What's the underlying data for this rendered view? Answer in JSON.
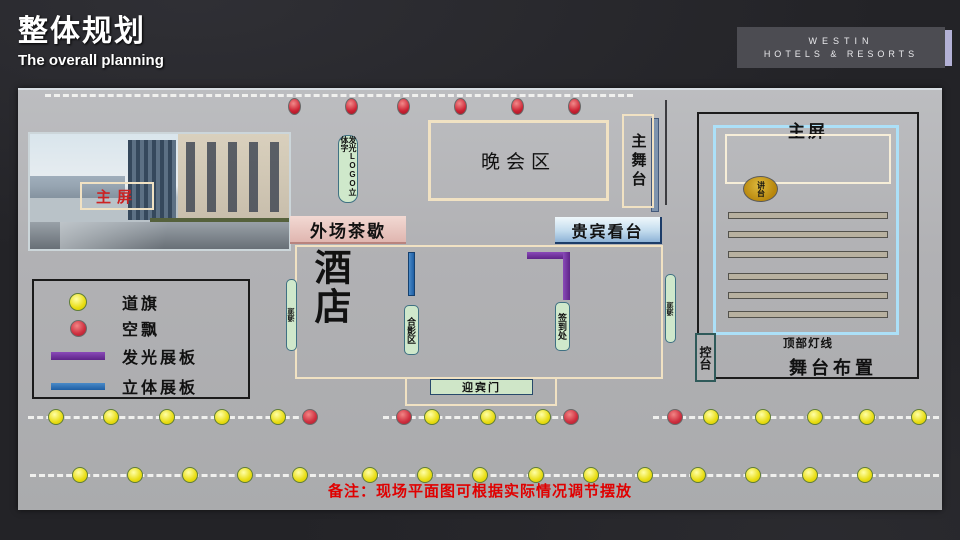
{
  "slide": {
    "title": "整体规划",
    "subtitle": "The overall planning",
    "brand_line1": "WESTIN",
    "brand_line2": "HOTELS & RESORTS"
  },
  "plan": {
    "photo_screen_label": "主屏",
    "logo_pillar_label": "发光LOGO立体字",
    "party_area_label": "晚会区",
    "main_stage_label": "主舞台",
    "tea_break_label": "外场茶歇",
    "vip_stand_label": "贵宾看台",
    "hotel_label": "酒店",
    "left_passage_label": "通道",
    "right_passage_label": "通道",
    "photo_area_label": "合影区",
    "signin_label": "签到处",
    "welcome_gate_label": "迎宾门",
    "note": "备注：现场平面图可根据实际情况调节摆放",
    "top_balloons": {
      "y": 8,
      "xs": [
        270,
        327,
        379,
        436,
        493,
        550
      ]
    },
    "dot_rows": [
      {
        "y": 319,
        "dots": [
          {
            "x": 30,
            "c": "yellow"
          },
          {
            "x": 85,
            "c": "yellow"
          },
          {
            "x": 141,
            "c": "yellow"
          },
          {
            "x": 196,
            "c": "yellow"
          },
          {
            "x": 252,
            "c": "yellow"
          },
          {
            "x": 284,
            "c": "red"
          },
          {
            "x": 378,
            "c": "red"
          },
          {
            "x": 406,
            "c": "yellow"
          },
          {
            "x": 462,
            "c": "yellow"
          },
          {
            "x": 517,
            "c": "yellow"
          },
          {
            "x": 545,
            "c": "red"
          },
          {
            "x": 649,
            "c": "red"
          },
          {
            "x": 685,
            "c": "yellow"
          },
          {
            "x": 737,
            "c": "yellow"
          },
          {
            "x": 789,
            "c": "yellow"
          },
          {
            "x": 841,
            "c": "yellow"
          },
          {
            "x": 893,
            "c": "yellow"
          }
        ]
      },
      {
        "y": 377,
        "dots": [
          {
            "x": 54,
            "c": "yellow"
          },
          {
            "x": 109,
            "c": "yellow"
          },
          {
            "x": 164,
            "c": "yellow"
          },
          {
            "x": 219,
            "c": "yellow"
          },
          {
            "x": 274,
            "c": "yellow"
          },
          {
            "x": 344,
            "c": "yellow"
          },
          {
            "x": 399,
            "c": "yellow"
          },
          {
            "x": 454,
            "c": "yellow"
          },
          {
            "x": 510,
            "c": "yellow"
          },
          {
            "x": 565,
            "c": "yellow"
          },
          {
            "x": 619,
            "c": "yellow"
          },
          {
            "x": 672,
            "c": "yellow"
          },
          {
            "x": 727,
            "c": "yellow"
          },
          {
            "x": 784,
            "c": "yellow"
          },
          {
            "x": 839,
            "c": "yellow"
          }
        ]
      }
    ]
  },
  "legend": {
    "items": [
      {
        "type": "yellow-dot",
        "label": "道旗"
      },
      {
        "type": "red-dot",
        "label": "空飘"
      },
      {
        "type": "purple-bar",
        "label": "发光展板"
      },
      {
        "type": "blue-bar",
        "label": "立体展板"
      }
    ]
  },
  "stage_panel": {
    "screen_label": "主屏",
    "podium_label": "讲台",
    "seat_rows": 6,
    "light_line_label": "顶部灯线",
    "console_label": "控台",
    "title": "舞台布置"
  },
  "colors": {
    "accent_cream": "#f1e2c3",
    "legend_yellow": "#e8dc10",
    "legend_red": "#cf3040",
    "legend_purple": "#7030a0",
    "legend_blue": "#2f75b6",
    "note_red": "#e00000",
    "brand_accent": "#b3b1d6",
    "plan_gray": "#b1b1b4"
  }
}
